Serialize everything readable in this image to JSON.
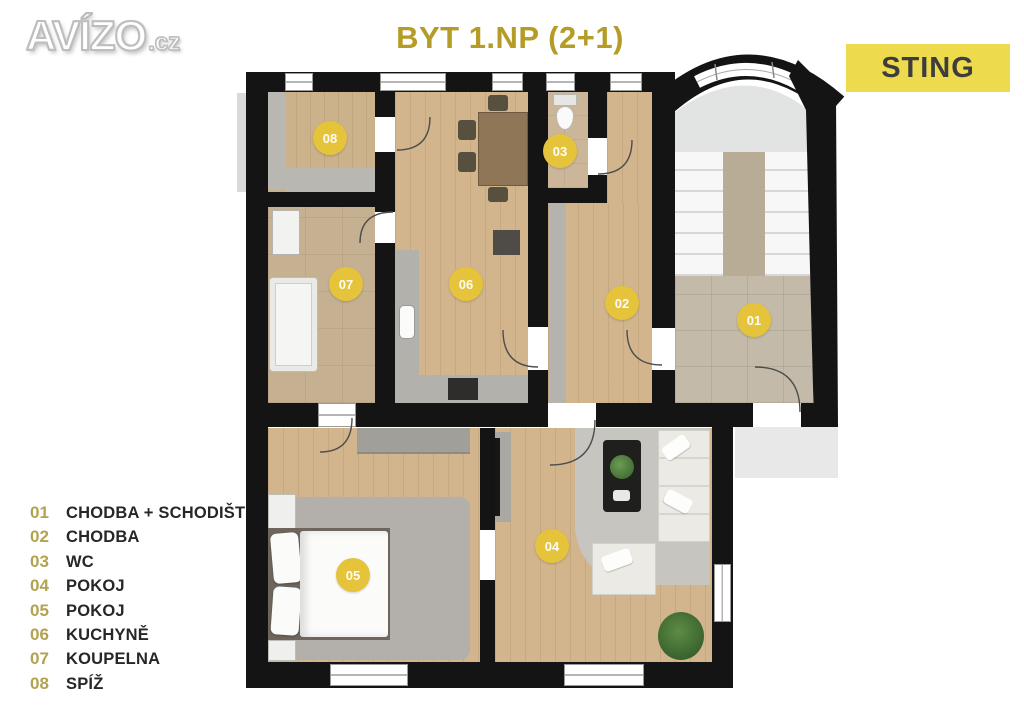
{
  "header": {
    "logo_text": "AVÍZO",
    "logo_suffix": ".cz",
    "title": "BYT 1.NP (2+1)",
    "badge": "STING"
  },
  "rooms": [
    {
      "number": "01",
      "label": "CHODBA + SCHODIŠTĚ"
    },
    {
      "number": "02",
      "label": "CHODBA"
    },
    {
      "number": "03",
      "label": "WC"
    },
    {
      "number": "04",
      "label": "POKOJ"
    },
    {
      "number": "05",
      "label": "POKOJ"
    },
    {
      "number": "06",
      "label": "KUCHYNĚ"
    },
    {
      "number": "07",
      "label": "KOUPELNA"
    },
    {
      "number": "08",
      "label": "SPÍŽ"
    }
  ],
  "colors": {
    "title_gold": "#b59c27",
    "badge_yellow": "#eeda4d",
    "marker_yellow": "#e5c33a",
    "legend_number": "#b3a250",
    "wall_black": "#141414",
    "wood_floor": "#d2b58c",
    "tile_floor": "#c6b092"
  }
}
